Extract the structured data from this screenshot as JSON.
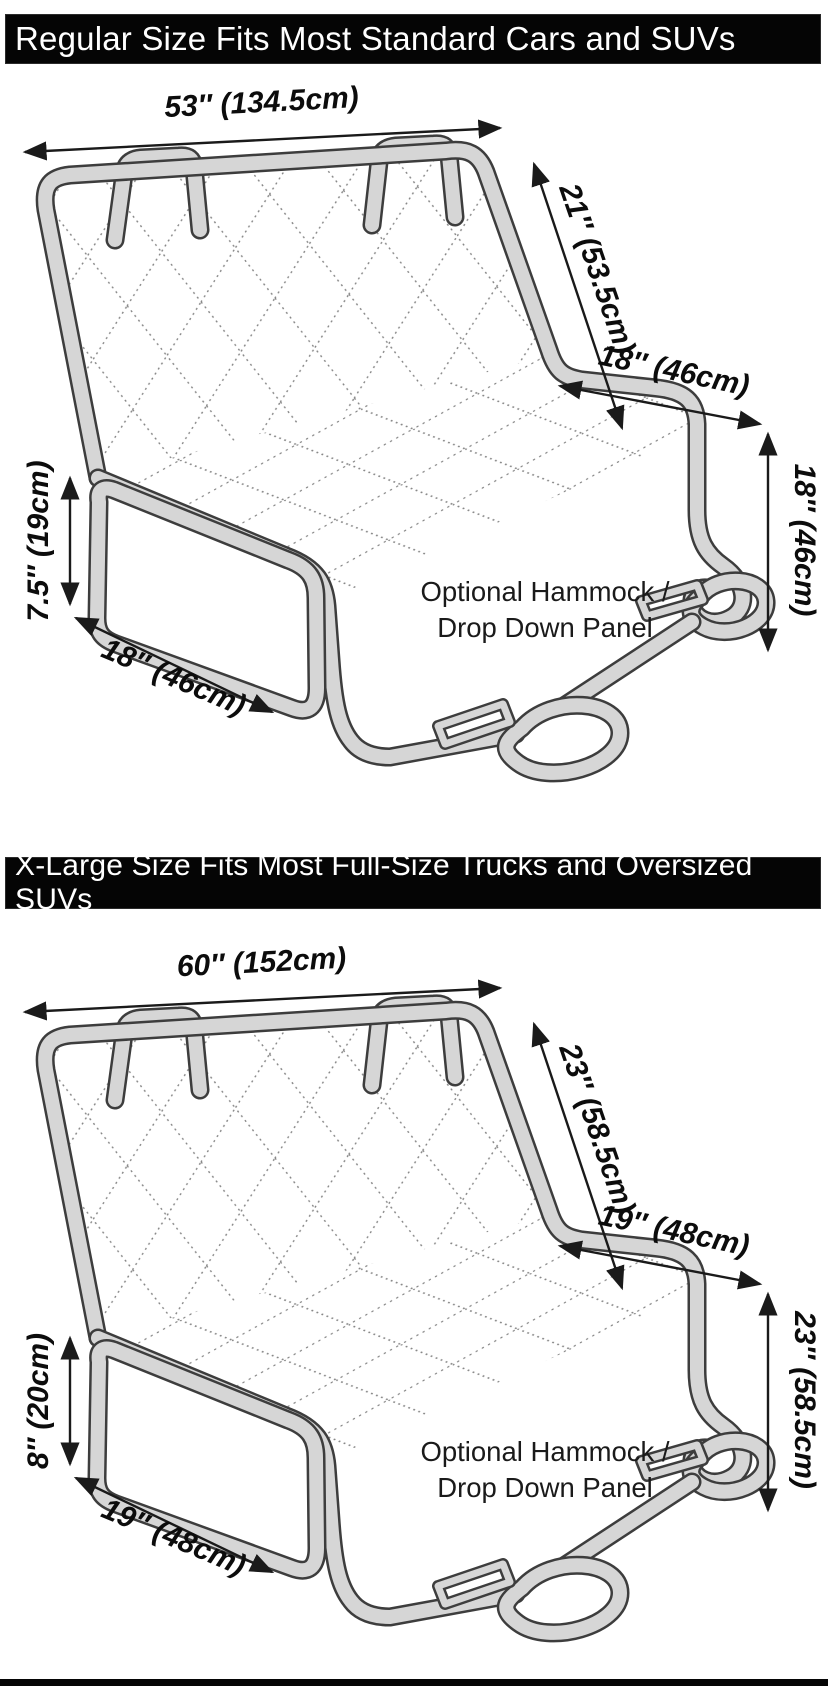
{
  "banners": {
    "regular": "Regular Size Fits Most Standard Cars and SUVs",
    "xlarge": "X-Large Size Fits Most Full-Size Trucks and Oversized SUVs"
  },
  "diagram1": {
    "name": "Regular size seat cover dimensions",
    "width": "53″ (134.5cm)",
    "back_height": "21″ (53.5cm)",
    "seat_depth": "18″ (46cm)",
    "side_drop": "18″ (46cm)",
    "flap_height": "7.5″ (19cm)",
    "flap_width": "18″ (46cm)",
    "hammock_line1": "Optional Hammock /",
    "hammock_line2": "Drop Down Panel"
  },
  "diagram2": {
    "name": "X-Large size seat cover dimensions",
    "width": "60″ (152cm)",
    "back_height": "23″ (58.5cm)",
    "seat_depth": "19″ (48cm)",
    "side_drop": "23″ (58.5cm)",
    "flap_height": "8″ (20cm)",
    "flap_width": "19″ (48cm)",
    "hammock_line1": "Optional Hammock /",
    "hammock_line2": "Drop Down Panel"
  },
  "colors": {
    "banner_bg": "#050505",
    "banner_text": "#ffffff",
    "tube_fill": "#d6d6d6",
    "tube_outline": "#3d3d3d",
    "quilt_stitch": "#848484",
    "dimension_lines": "#1a1a1a"
  }
}
